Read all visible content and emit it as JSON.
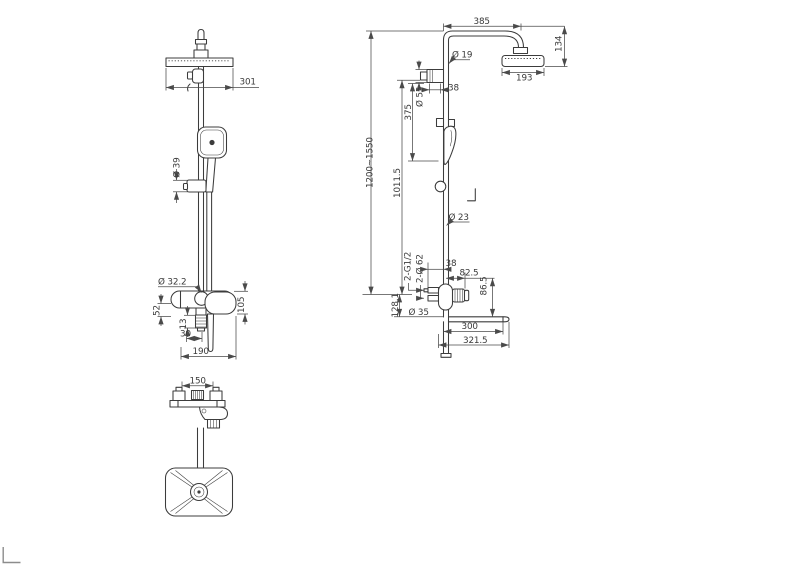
{
  "colors": {
    "background": "#ffffff",
    "drawing_line": "#3c3c3c",
    "dimension_line": "#4a4a4a",
    "text": "#3a3a3a",
    "frame_mark": "#8c8c8c"
  },
  "front_view": {
    "dims": {
      "head_width": "301",
      "handle_dia": "Ø 39",
      "body_dia": "Ø 32.2",
      "body_height": "52",
      "thread_len": "13",
      "stub_width": "30",
      "mixer_height": "105",
      "mixer_width": "190"
    }
  },
  "top_view": {
    "dims": {
      "inlet_spacing": "150"
    }
  },
  "side_view": {
    "dims": {
      "arm_length": "385",
      "head_drop": "134",
      "pipe_dia": "Ø 19",
      "head_width": "193",
      "diverter_offset": "38",
      "diverter_dia": "Ø 55",
      "upper_span": "375",
      "height_range": "1200~1550",
      "riser_height": "1011.5",
      "slide_dia": "Ø 23",
      "inlet_thread": "2-G1/2",
      "escutcheon_dia": "2-Ø 62",
      "lower_offset": "38",
      "handle_reach": "82.5",
      "spout_drop": "86.5",
      "base_height": "128.1",
      "supply_dia": "Ø 35",
      "shelf_length": "300",
      "shelf_total": "321.5"
    }
  }
}
